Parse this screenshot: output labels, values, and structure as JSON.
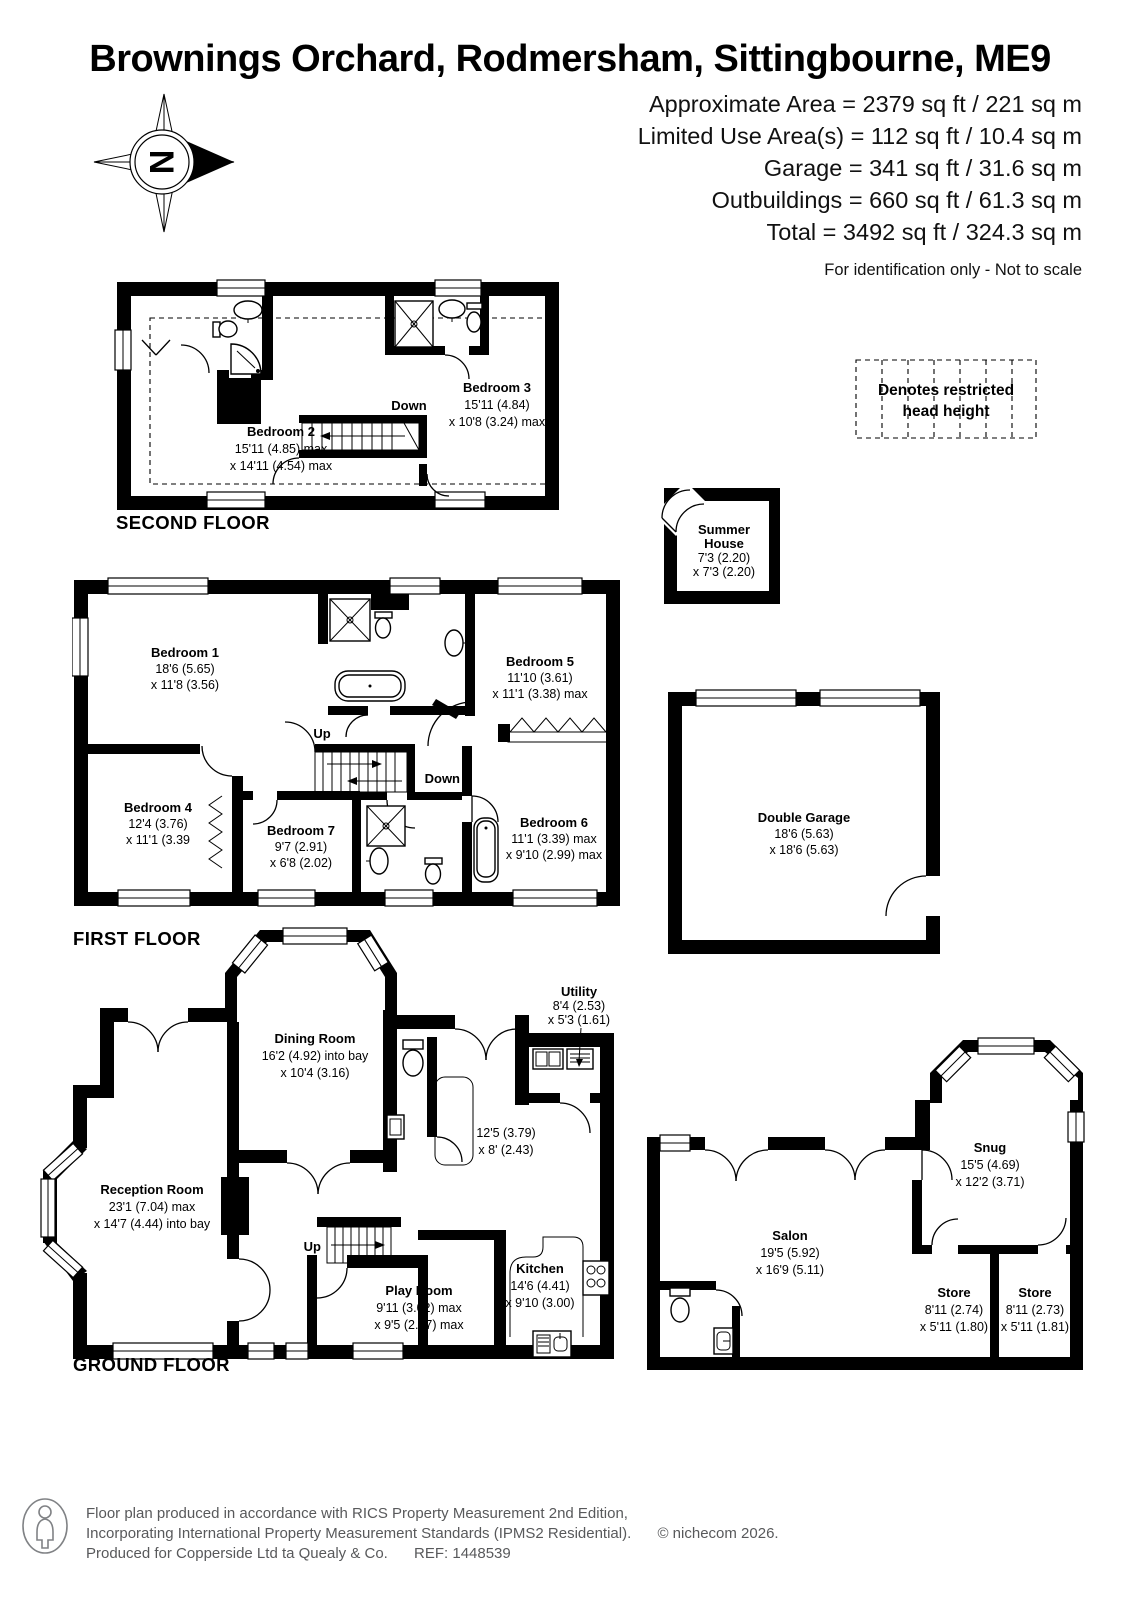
{
  "header": {
    "title": "Brownings Orchard, Rodmersham, Sittingbourne, ME9",
    "areas": [
      "Approximate Area = 2379 sq ft / 221 sq m",
      "Limited Use Area(s) = 112 sq ft / 10.4 sq m",
      "Garage = 341 sq ft / 31.6 sq m",
      "Outbuildings = 660 sq ft / 61.3 sq m",
      "Total = 3492 sq ft / 324.3 sq m"
    ],
    "disclaimer": "For identification only - Not to scale",
    "compass_letter": "N"
  },
  "legend": {
    "line1": "Denotes restricted",
    "line2": "head height"
  },
  "second_floor": {
    "label": "SECOND FLOOR",
    "down": "Down",
    "bedroom2": {
      "name": "Bedroom 2",
      "d1": "15'11 (4.85) max",
      "d2": "x 14'11 (4.54) max"
    },
    "bedroom3": {
      "name": "Bedroom 3",
      "d1": "15'11 (4.84)",
      "d2": "x 10'8 (3.24) max"
    }
  },
  "summer_house": {
    "name1": "Summer",
    "name2": "House",
    "d1": "7'3 (2.20)",
    "d2": "x 7'3 (2.20)"
  },
  "first_floor": {
    "label": "FIRST FLOOR",
    "up": "Up",
    "down": "Down",
    "bedroom1": {
      "name": "Bedroom 1",
      "d1": "18'6 (5.65)",
      "d2": "x 11'8 (3.56)"
    },
    "bedroom5": {
      "name": "Bedroom 5",
      "d1": "11'10 (3.61)",
      "d2": "x 11'1 (3.38) max"
    },
    "bedroom4": {
      "name": "Bedroom 4",
      "d1": "12'4 (3.76)",
      "d2": "x 11'1 (3.39"
    },
    "bedroom7": {
      "name": "Bedroom 7",
      "d1": "9'7 (2.91)",
      "d2": "x 6'8 (2.02)"
    },
    "bedroom6": {
      "name": "Bedroom 6",
      "d1": "11'1 (3.39) max",
      "d2": "x 9'10 (2.99) max"
    }
  },
  "garage": {
    "name": "Double Garage",
    "d1": "18'6 (5.63)",
    "d2": "x 18'6 (5.63)"
  },
  "ground_floor": {
    "label": "GROUND FLOOR",
    "up": "Up",
    "reception": {
      "name": "Reception Room",
      "d1": "23'1 (7.04) max",
      "d2": "x 14'7 (4.44) into bay"
    },
    "dining": {
      "name": "Dining Room",
      "d1": "16'2 (4.92) into bay",
      "d2": "x 10'4 (3.16)"
    },
    "utility": {
      "name": "Utility",
      "d1": "8'4 (2.53)",
      "d2": "x 5'3 (1.61)"
    },
    "hall": {
      "d1": "12'5 (3.79)",
      "d2": "x 8' (2.43)"
    },
    "kitchen": {
      "name": "Kitchen",
      "d1": "14'6 (4.41)",
      "d2": "x 9'10 (3.00)"
    },
    "playroom": {
      "name": "Play Room",
      "d1": "9'11 (3.02) max",
      "d2": "x 9'5 (2.87) max"
    },
    "salon": {
      "name": "Salon",
      "d1": "19'5 (5.92)",
      "d2": "x 16'9 (5.11)"
    },
    "snug": {
      "name": "Snug",
      "d1": "15'5 (4.69)",
      "d2": "x 12'2 (3.71)"
    },
    "store1": {
      "name": "Store",
      "d1": "8'11 (2.74)",
      "d2": "x 5'11 (1.80)"
    },
    "store2": {
      "name": "Store",
      "d1": "8'11 (2.73)",
      "d2": "x 5'11 (1.81)"
    }
  },
  "footer": {
    "line1": "Floor plan produced in accordance with RICS Property Measurement 2nd Edition,",
    "line2": "Incorporating International Property Measurement Standards (IPMS2 Residential).",
    "copyright": "© nichecom 2026.",
    "line3a": "Produced for Copperside Ltd ta Quealy & Co.",
    "line3b": "REF: 1448539"
  },
  "colors": {
    "wall": "#000000",
    "footer_text": "#58595b"
  }
}
